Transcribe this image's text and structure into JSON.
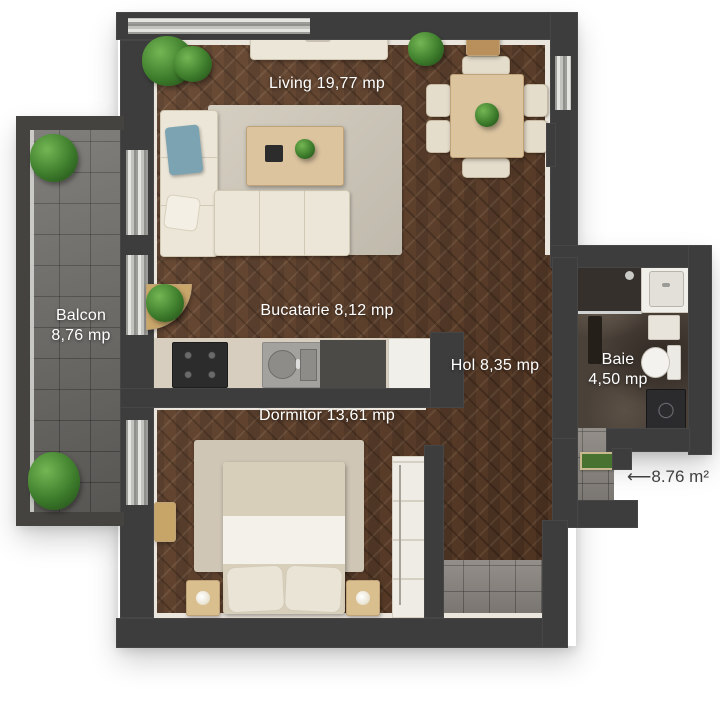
{
  "floor_plan": {
    "type": "apartment-top-view-render",
    "unit_label": "mp",
    "rooms": {
      "living": {
        "name": "Living",
        "area": "19,77",
        "label": "Living 19,77 mp"
      },
      "bucatarie": {
        "name": "Bucatarie",
        "area": "8,12",
        "label": "Bucatarie  8,12 mp"
      },
      "balcon": {
        "name": "Balcon",
        "area": "8,76",
        "label_line1": "Balcon",
        "label_line2": "8,76 mp"
      },
      "hol": {
        "name": "Hol",
        "area": "8,35",
        "label": "Hol 8,35 mp"
      },
      "baie": {
        "name": "Baie",
        "area": "4,50",
        "label_line1": "Baie",
        "label_line2": "4,50 mp"
      },
      "dormitor": {
        "name": "Dormitor",
        "area": "13,61",
        "label": "Dormitor 13,61 mp"
      }
    },
    "annotation": {
      "entrance_note": "⟵8.76 m²"
    },
    "colors": {
      "wall": "#3d3d3d",
      "wood_floor": "#5b3d2a",
      "balcony_tile": "#73716d",
      "bathroom_floor": "#4a4139",
      "entry_stone": "#8b8680",
      "rug": "#d0c9bb",
      "upholstery": "#ece6d8",
      "light_wood": "#dcc49f",
      "doormat_green": "#47722f",
      "plant_green": "#3e7d2c",
      "room_label_text": "#ffffff",
      "annotation_text": "#3f3f3f"
    }
  }
}
